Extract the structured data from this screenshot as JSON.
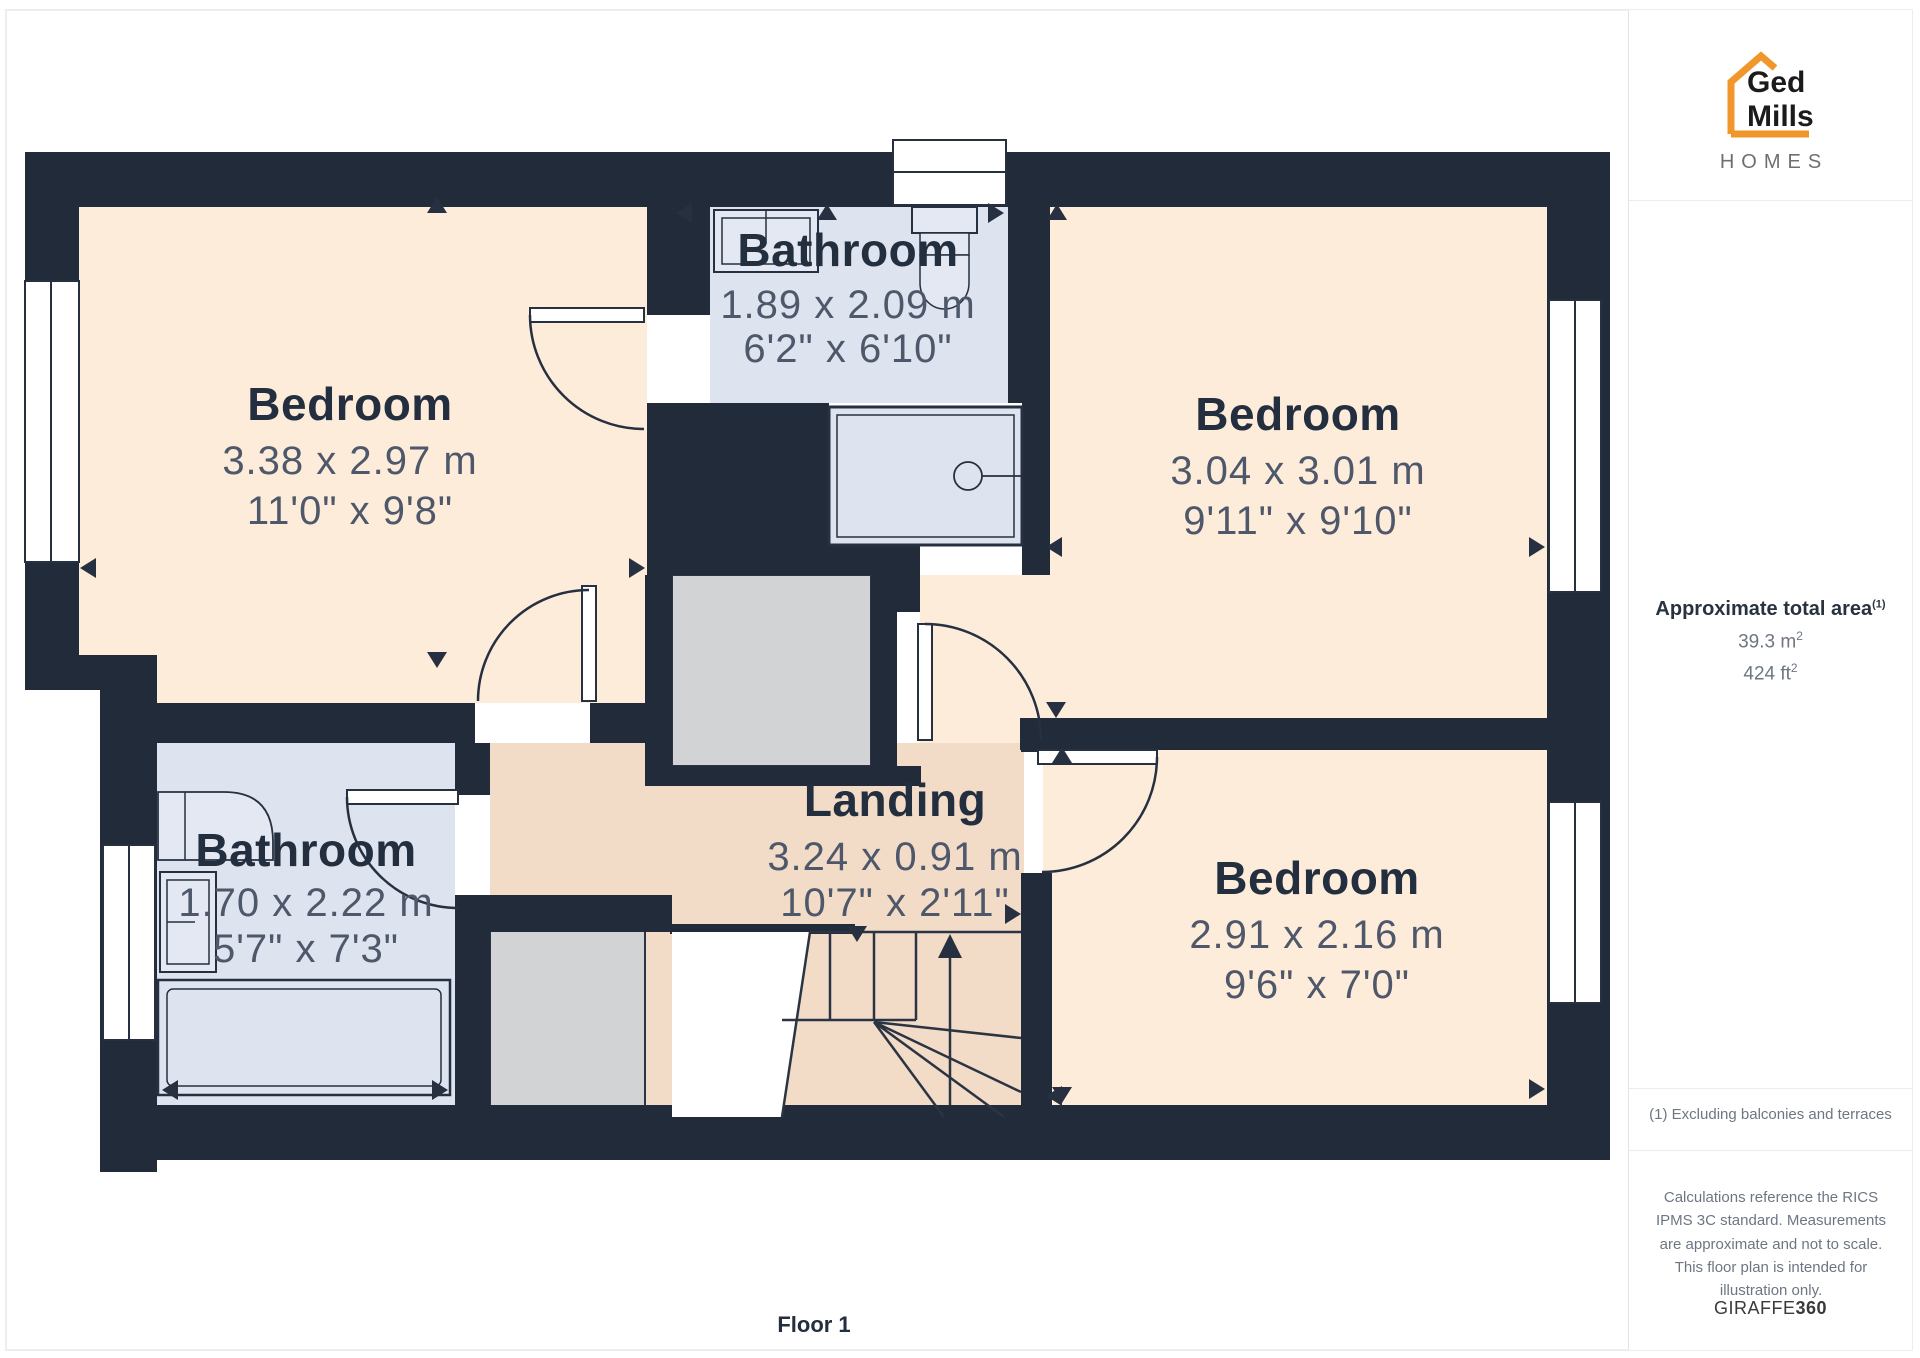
{
  "floorplan": {
    "floor_label": "Floor 1",
    "rooms": [
      {
        "id": "bedroom-1",
        "name": "Bedroom",
        "dims_metric": "3.38 x 2.97 m",
        "dims_imperial": "11'0\" x 9'8\""
      },
      {
        "id": "bathroom-1",
        "name": "Bathroom",
        "dims_metric": "1.89 x 2.09 m",
        "dims_imperial": "6'2\" x 6'10\""
      },
      {
        "id": "bedroom-2",
        "name": "Bedroom",
        "dims_metric": "3.04 x 3.01 m",
        "dims_imperial": "9'11\" x 9'10\""
      },
      {
        "id": "bathroom-2",
        "name": "Bathroom",
        "dims_metric": "1.70 x 2.22 m",
        "dims_imperial": "5'7\" x 7'3\""
      },
      {
        "id": "landing",
        "name": "Landing",
        "dims_metric": "3.24 x 0.91 m",
        "dims_imperial": "10'7\" x 2'11\""
      },
      {
        "id": "bedroom-3",
        "name": "Bedroom",
        "dims_metric": "2.91 x 2.16 m",
        "dims_imperial": "9'6\" x 7'0\""
      }
    ],
    "colors": {
      "wall": "#212b3a",
      "bedroom_fill": "#fdecda",
      "bathroom_fill": "#dde4ef",
      "landing_fill": "#f2dcc7",
      "stairwell_fill": "#d2d3d5",
      "label_text": "#232e3f",
      "dims_text": "#4e586a"
    }
  },
  "sidebar": {
    "logo": {
      "line1": "Ged",
      "line2": "Mills",
      "line3": "HOMES",
      "accent_color": "#f0962a"
    },
    "area": {
      "title": "Approximate total area",
      "title_superscript": "(1)",
      "metric_value": "39.3 m",
      "metric_sup": "2",
      "imperial_value": "424 ft",
      "imperial_sup": "2"
    },
    "footnote": "(1) Excluding balconies and terraces",
    "disclaimer": "Calculations reference the RICS IPMS 3C standard. Measurements are approximate and not to scale. This floor plan is intended for illustration only.",
    "brand": {
      "name": "GIRAFFE",
      "suffix": "360"
    }
  }
}
